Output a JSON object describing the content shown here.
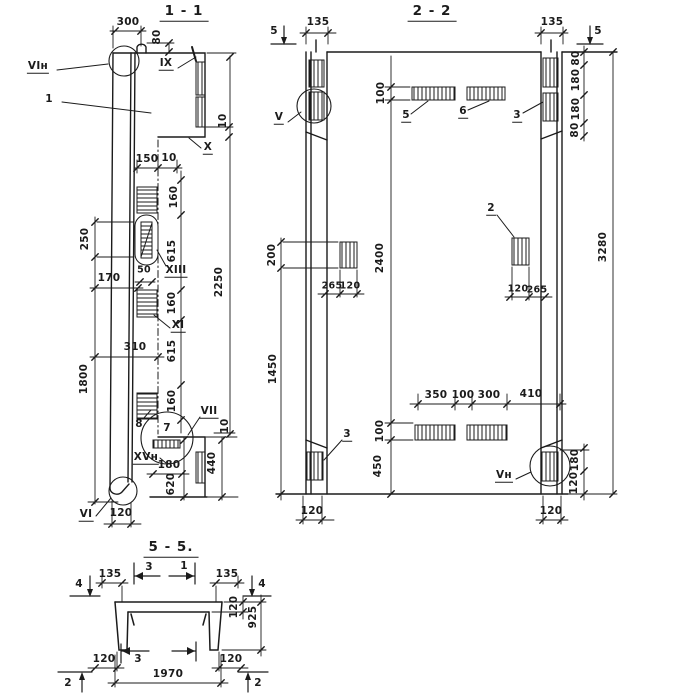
{
  "drawing": {
    "background": "#ffffff",
    "ink": "#1b1b1b",
    "type": "reinforced-concrete-panel-sections"
  },
  "section_1_1": {
    "title": "1 - 1",
    "labels": {
      "v1n": "VIн",
      "n1": "1",
      "ix": "IX",
      "x": "X",
      "xiii": "XIII",
      "xi": "XI",
      "vii": "VII",
      "xvn": "XVн",
      "vi": "VI",
      "n7": "7",
      "n8": "8"
    },
    "dims": {
      "d300": "300",
      "d80": "80",
      "d10_top": "10",
      "d150": "150",
      "d10_mid": "10",
      "d160a": "160",
      "d615a": "615",
      "d160b": "160",
      "d615b": "615",
      "d160c": "160",
      "d250": "250",
      "d170": "170",
      "d50": "50",
      "d310": "310",
      "d1800": "1800",
      "d2250": "2250",
      "d10_bottom": "10",
      "d180": "180",
      "d620": "620",
      "d440": "440",
      "d120": "120"
    }
  },
  "section_2_2": {
    "title": "2 - 2",
    "labels": {
      "v": "V",
      "vn": "Vн",
      "n2": "2",
      "n3_top": "3",
      "n3_bottom": "3",
      "n5": "5",
      "n6": "6",
      "m5_left": "5",
      "m5_right": "5"
    },
    "dims": {
      "d135_left": "135",
      "d135_right": "135",
      "d80_top": "80",
      "d180_top": "180",
      "d180_mid": "180",
      "d80_mid": "80",
      "d3280": "3280",
      "d100_top": "100",
      "d200": "200",
      "d2400": "2400",
      "d265_left": "265",
      "d120_left": "120",
      "d120_right": "120",
      "d265_right": "265",
      "d1450": "1450",
      "d350": "350",
      "d100_mid": "100",
      "d300": "300",
      "d410": "410",
      "d100_bottom": "100",
      "d450": "450",
      "d180_right": "180",
      "d120_right_bottom": "120",
      "d120_bottom_left": "120",
      "d120_bottom_right": "120"
    }
  },
  "section_5_5": {
    "title": "5 - 5.",
    "labels": {
      "m4_left": "4",
      "m4_right": "4",
      "m3_top": "3",
      "m1_top": "1",
      "m3_bottom": "3",
      "m2_left": "2",
      "m2_right": "2"
    },
    "dims": {
      "d135_left": "135",
      "d135_right": "135",
      "d120_flange": "120",
      "d925": "925",
      "d120_bottom_left": "120",
      "d120_bottom_right": "120",
      "d1970": "1970"
    }
  }
}
